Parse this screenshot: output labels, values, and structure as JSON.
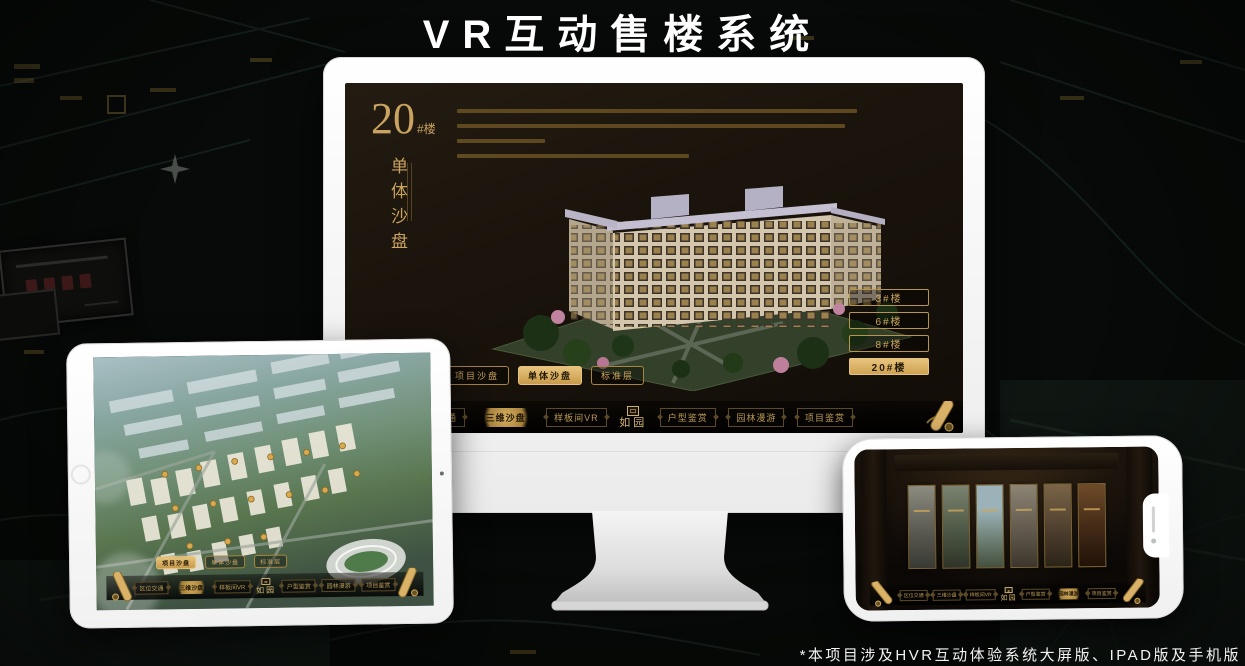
{
  "title": "VR互动售楼系统",
  "footnote": "*本项目涉及HVR互动体验系统大屏版、IPAD版及手机版",
  "shared": {
    "nav_items": [
      "区位交通",
      "三维沙盘",
      "样板间VR",
      "户型鉴赏",
      "园林漫游",
      "项目鉴赏"
    ],
    "nav_logo": "如园",
    "sub_tabs": [
      "项目沙盘",
      "单体沙盘",
      "标准层"
    ]
  },
  "monitor_app": {
    "heading_number": "20",
    "heading_unit": "#楼",
    "heading_subtitle": "单体沙盘",
    "floor_buttons": [
      "3#楼",
      "6#楼",
      "8#楼",
      "20#楼"
    ],
    "active_floor": "20#楼",
    "active_sub_tab": "单体沙盘",
    "active_nav": "三维沙盘"
  },
  "tablet_app": {
    "active_sub_tab": "项目沙盘",
    "active_nav": "三维沙盘"
  },
  "phone_app": {
    "active_nav": "园林漫游"
  },
  "colors": {
    "gold": "#c9a35f",
    "gold_fill": "#d9b268",
    "screen_background": "#17110b"
  }
}
